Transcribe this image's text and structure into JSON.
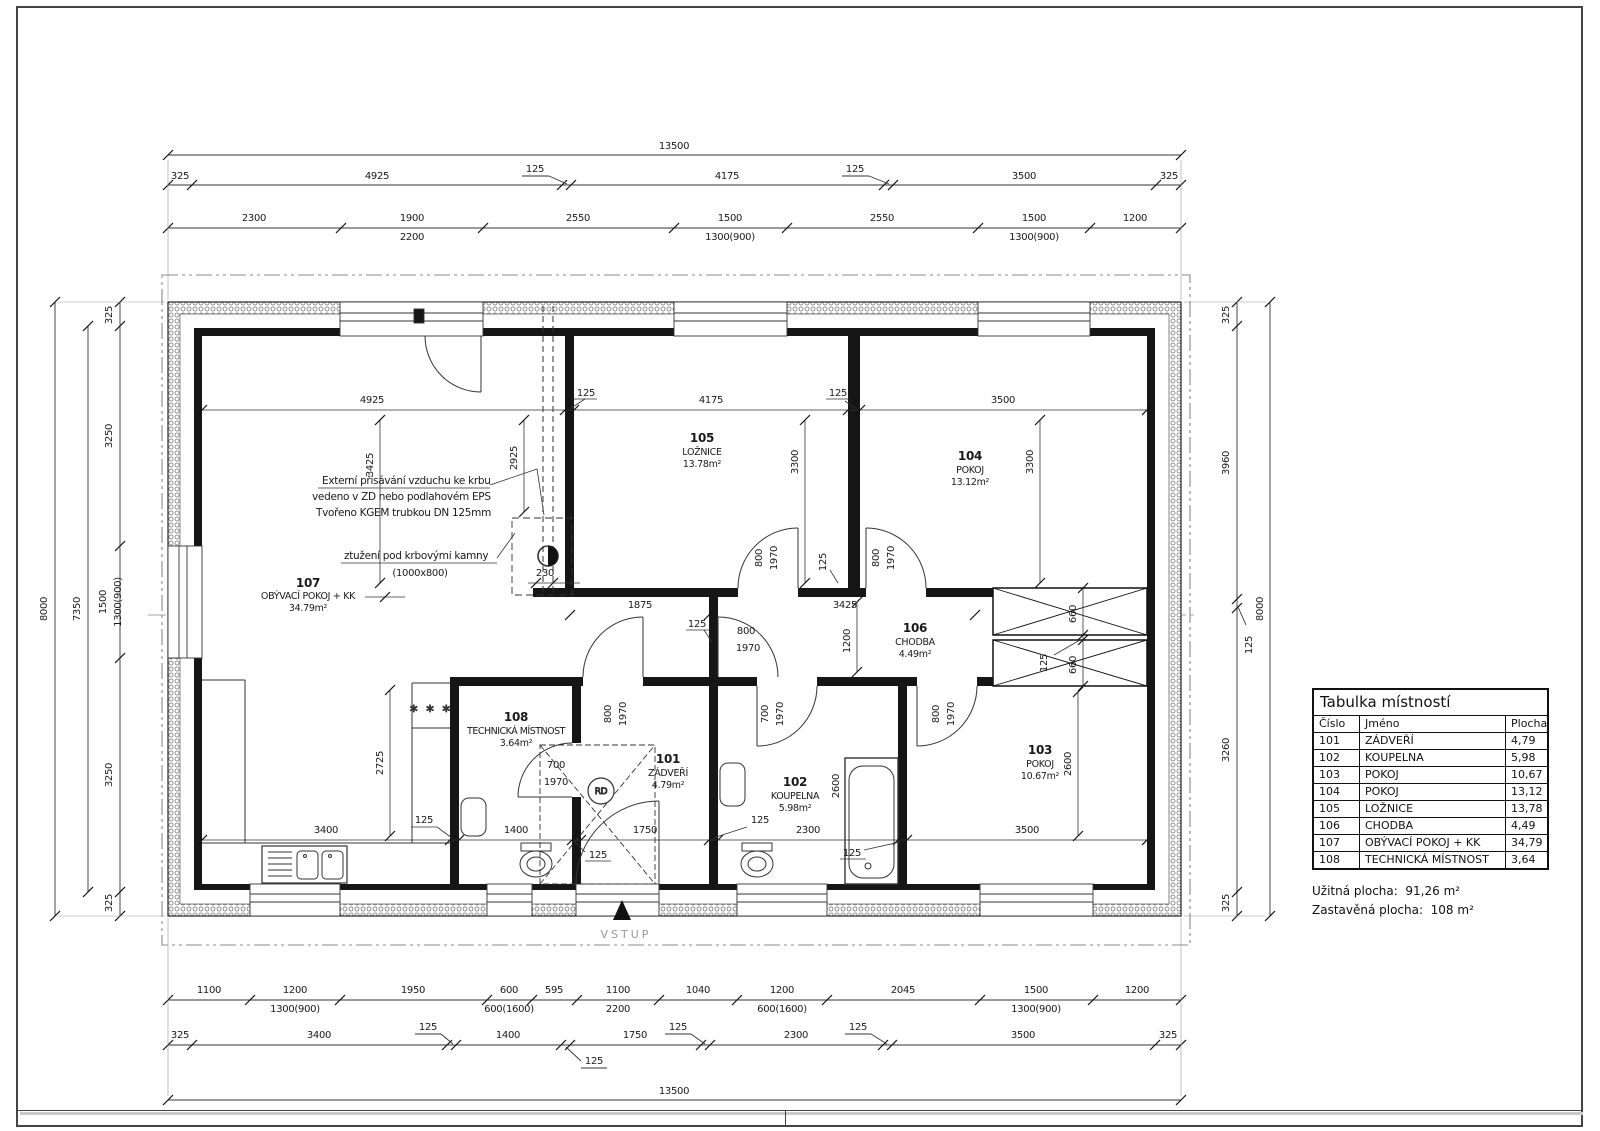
{
  "table": {
    "title": "Tabulka místností",
    "headers": {
      "number": "Číslo",
      "name": "Jméno",
      "area": "Plocha"
    },
    "rows": [
      {
        "number": "101",
        "name": "ZÁDVEŘÍ",
        "area": "4,79"
      },
      {
        "number": "102",
        "name": "KOUPELNA",
        "area": "5,98"
      },
      {
        "number": "103",
        "name": "POKOJ",
        "area": "10,67"
      },
      {
        "number": "104",
        "name": "POKOJ",
        "area": "13,12"
      },
      {
        "number": "105",
        "name": "LOŽNICE",
        "area": "13,78"
      },
      {
        "number": "106",
        "name": "CHODBA",
        "area": "4,49"
      },
      {
        "number": "107",
        "name": "OBÝVACÍ POKOJ + KK",
        "area": "34,79"
      },
      {
        "number": "108",
        "name": "TECHNICKÁ MÍSTNOST",
        "area": "3,64"
      }
    ],
    "useful_area": "Užitná plocha:  91,26 m²",
    "built_area": "Zastavěná plocha:  108 m²"
  },
  "rooms": [
    {
      "num": "107",
      "name": "OBÝVACÍ POKOJ + KK",
      "area": "34.79m²"
    },
    {
      "num": "105",
      "name": "LOŽNICE",
      "area": "13.78m²"
    },
    {
      "num": "104",
      "name": "POKOJ",
      "area": "13.12m²"
    },
    {
      "num": "106",
      "name": "CHODBA",
      "area": "4.49m²"
    },
    {
      "num": "103",
      "name": "POKOJ",
      "area": "10.67m²"
    },
    {
      "num": "102",
      "name": "KOUPELNA",
      "area": "5.98m²"
    },
    {
      "num": "101",
      "name": "ZÁDVEŘÍ",
      "area": "4.79m²"
    },
    {
      "num": "108",
      "name": "TECHNICKÁ MÍSTNOST",
      "area": "3.64m²"
    }
  ],
  "annotations": {
    "air1": "Externí přisávání vzduchu ke krbu",
    "air2": "vedeno v ZD nebo podlahovém EPS",
    "air3": "Tvořeno  KGEM trubkou DN 125mm",
    "stiff1": "ztužení pod krbovými kamny",
    "stiff2": "(1000x800)",
    "entrance": "VSTUP",
    "rd": "RD",
    "stove": "* * *"
  },
  "dims": {
    "t13500": "13500",
    "t8000": "8000",
    "t7350": "7350",
    "top2": [
      "325",
      "4925",
      "125",
      "4175",
      "125",
      "3500",
      "325"
    ],
    "top3": [
      "2300",
      "1900",
      "2550",
      "1500",
      "2550",
      "1500",
      "1200"
    ],
    "top3sub": [
      "2200",
      "1300(900)",
      "1300(900)"
    ],
    "bot1": [
      "1100",
      "1200",
      "1950",
      "600",
      "595",
      "1100",
      "1040",
      "1200",
      "2045",
      "1500",
      "1200"
    ],
    "bot1sub": [
      "1300(900)",
      "600(1600)",
      "2200",
      "600(1600)",
      "1300(900)"
    ],
    "bot2": [
      "325",
      "3400",
      "125",
      "1400",
      "125",
      "1750",
      "125",
      "2300",
      "125",
      "3500",
      "325"
    ],
    "left": [
      "325",
      "3250",
      "1500",
      "3250",
      "325"
    ],
    "leftsub": "1300(900)",
    "right": [
      "325",
      "3960",
      "125",
      "3260",
      "325"
    ],
    "intop": [
      "4925",
      "125",
      "4175",
      "125",
      "3500"
    ],
    "inbot": [
      "3400",
      "125",
      "1400",
      "125",
      "1750",
      "125",
      "2300",
      "125",
      "3500"
    ],
    "v": {
      "a3425": "3425",
      "a2925": "2925",
      "a3300": "3300",
      "a1200": "1200",
      "a2725": "2725",
      "a2600": "2600",
      "a660": "660",
      "a125": "125",
      "a230": "230",
      "a1875": "1875",
      "a3425h": "3425"
    },
    "door": {
      "w800": "800",
      "w700": "700",
      "h1970": "1970"
    }
  }
}
